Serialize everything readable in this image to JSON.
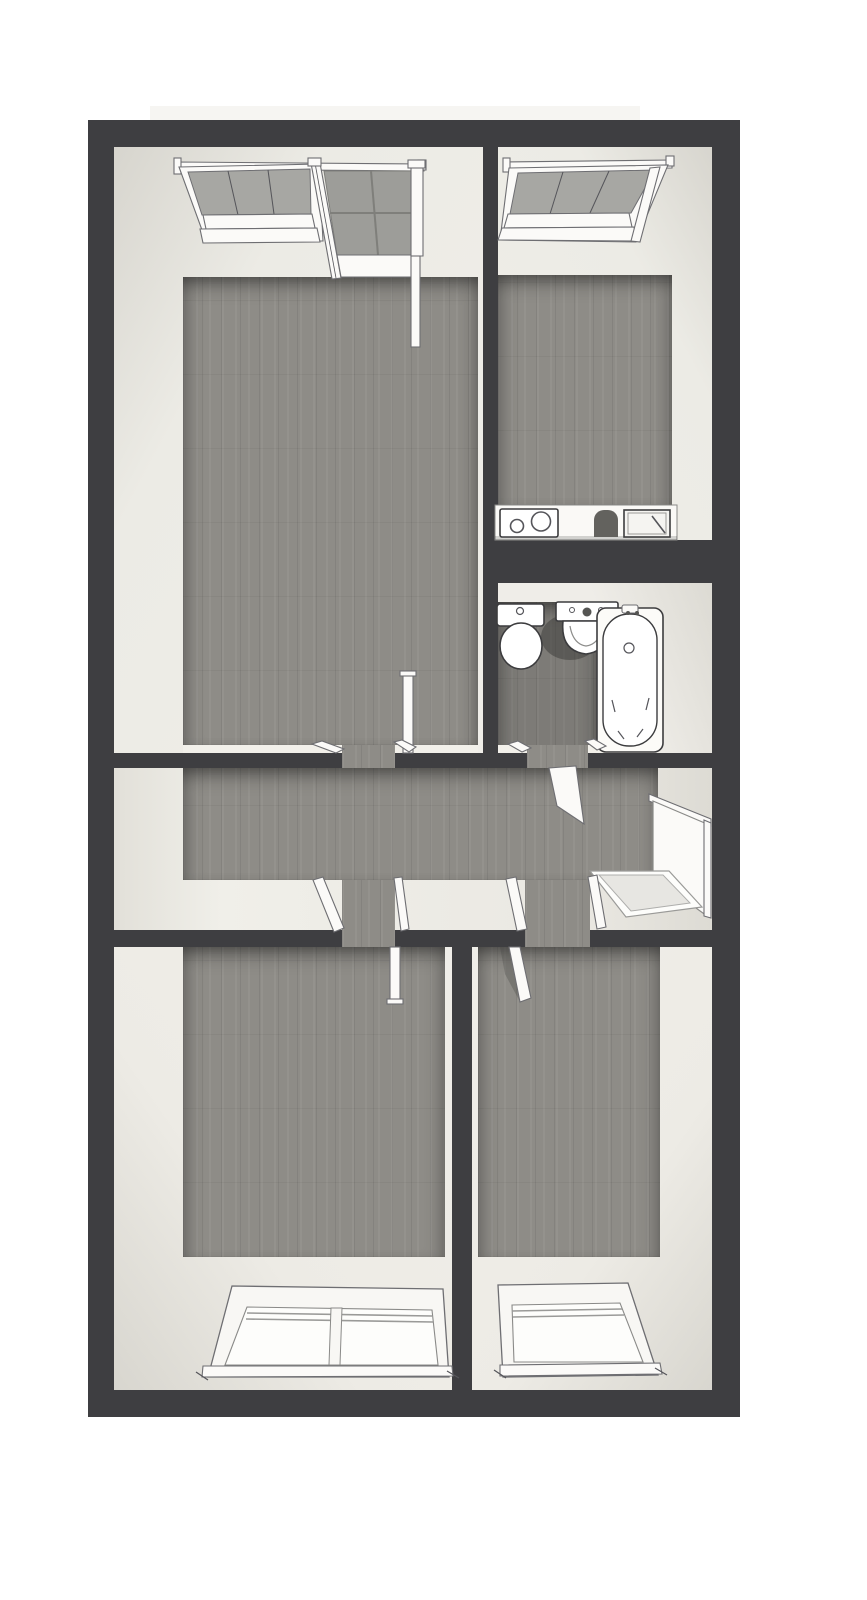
{
  "scene": {
    "kind": "3d-floor-plan-top-view",
    "style": "rendered dollhouse view, no text labels"
  },
  "palette": {
    "bg": "#ffffff",
    "wall_dark": "#3e3e41",
    "wall_face": "#ebe9e3",
    "wall_face_shade": "#d7d5ce",
    "floor_wood": "#8e8c87",
    "balcony_tile": "#9d9d99",
    "tile_grout": "#7f7f7b",
    "window_glass_gray": "#a7a7a3",
    "fixture_white": "#fcfbf8",
    "outline": "#3c3c3e",
    "doormat": "#e7e6e2",
    "balcony_slab": "#f6f5f2"
  },
  "rooms": [
    {
      "name": "living-room",
      "position": "top-left",
      "fixtures": [
        "tilted-open-window",
        "balcony-door-with-tiled-balcony",
        "open-door-leaf-to-hallway"
      ]
    },
    {
      "name": "kitchen",
      "position": "top-right",
      "fixtures": [
        "tilted-open-window",
        "counter-with-cooktop",
        "counter-sink-with-faucet"
      ]
    },
    {
      "name": "bathroom",
      "position": "middle-right",
      "fixtures": [
        "toilet",
        "wash-basin",
        "bathtub",
        "open-door-to-hallway"
      ]
    },
    {
      "name": "hallway",
      "position": "middle",
      "fixtures": [
        "entrance-door",
        "doormat",
        "door-openings-with-jambs"
      ]
    },
    {
      "name": "bedroom-left",
      "position": "bottom-left",
      "fixtures": [
        "double-window",
        "open-door-leaf"
      ]
    },
    {
      "name": "bedroom-right",
      "position": "bottom-right",
      "fixtures": [
        "single-window",
        "open-door-leaf"
      ]
    }
  ]
}
